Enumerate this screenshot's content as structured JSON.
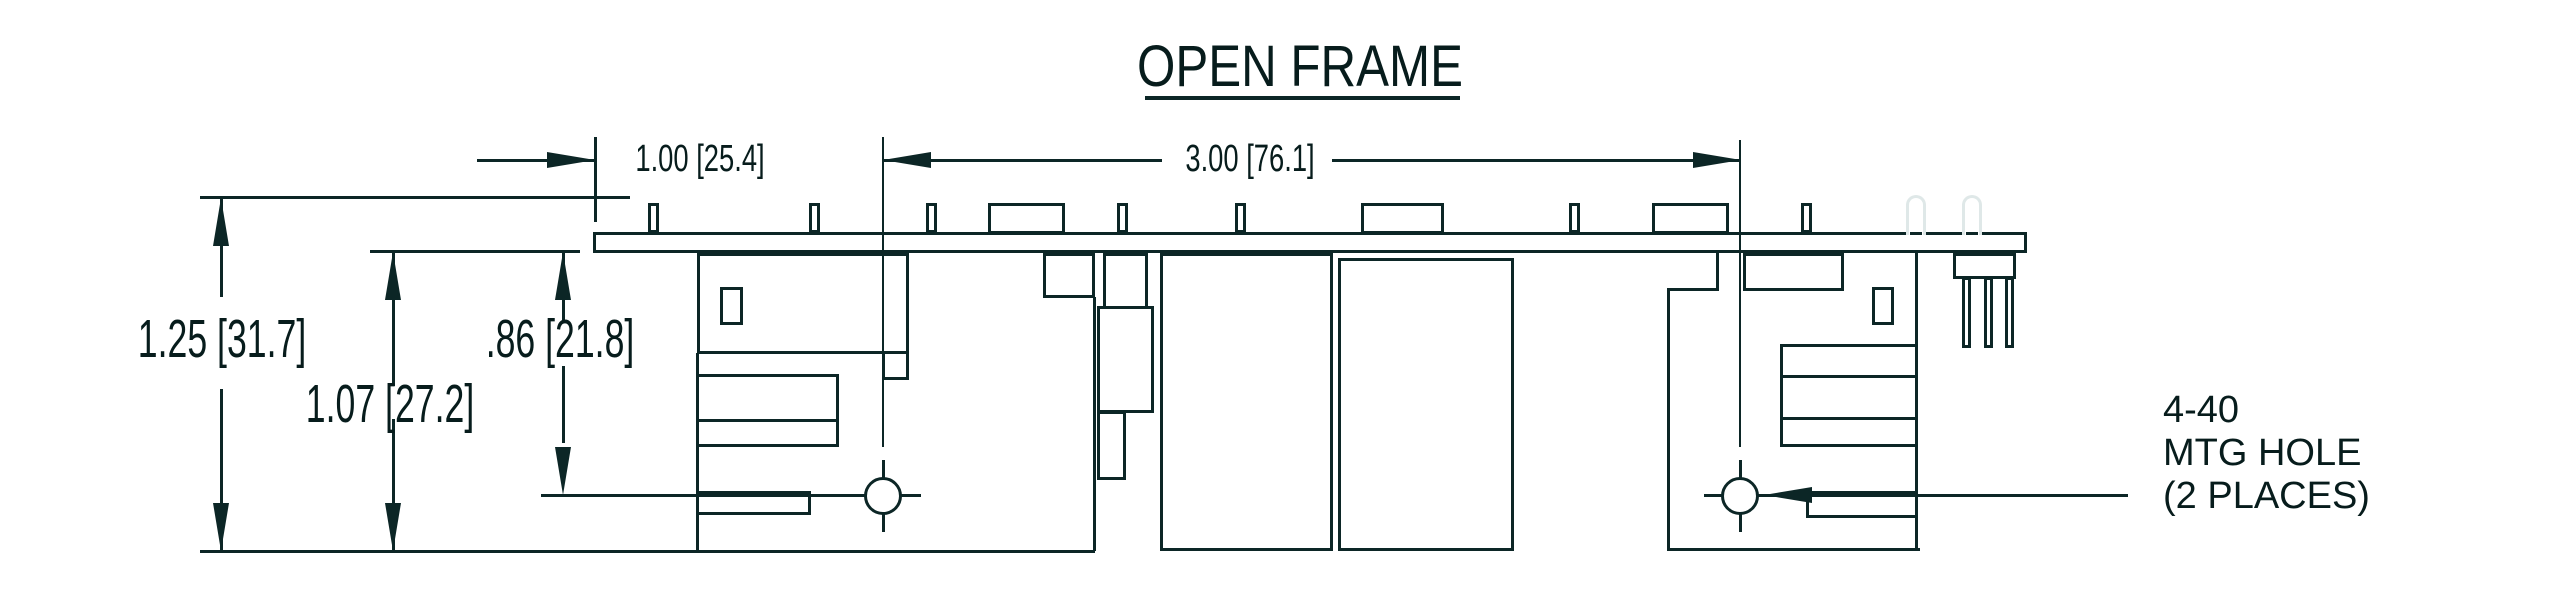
{
  "title": {
    "text": "OPEN FRAME"
  },
  "dimensions": {
    "board_left_to_hole": {
      "label": "1.00 [25.4]"
    },
    "hole_to_hole": {
      "label": "3.00 [76.1]"
    },
    "overall_height": {
      "label": "1.25 [31.7]"
    },
    "board_to_bottom": {
      "label": "1.07 [27.2]"
    },
    "board_to_hole": {
      "label": ".86 [21.8]"
    }
  },
  "mounting_note": {
    "line1": "4-40",
    "line2": "MTG HOLE",
    "line3": "(2 PLACES)"
  },
  "colors": {
    "line": "#0c2626",
    "text": "#071c1c",
    "phantom_pin": "#dfe8e8",
    "background": "#ffffff"
  }
}
